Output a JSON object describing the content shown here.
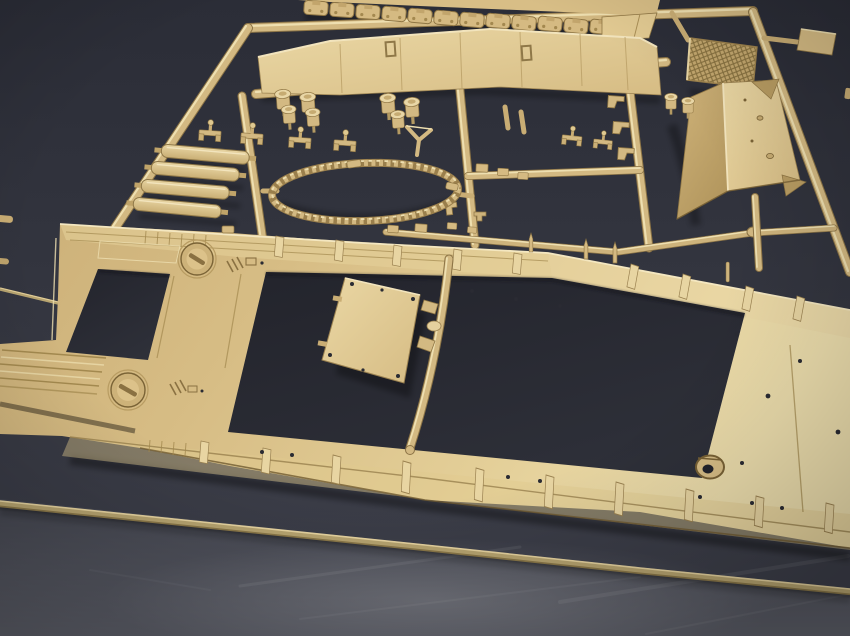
{
  "scene": {
    "type": "photograph",
    "description": "Close-up photo of a sand-tan injection-molded plastic model kit sprue (parts tree) lying on a dark blue-gray studio surface",
    "palette": {
      "backdrop_top": "#2b2d37",
      "backdrop_bottom": "#3e404b",
      "floor_top": "#464852",
      "floor_bottom": "#5d5f69",
      "plastic_base": "#d3b982",
      "plastic_light": "#e9d7a7",
      "plastic_bright": "#f2e4bd",
      "plastic_mid": "#c6ab72",
      "plastic_dark": "#a3894f",
      "plastic_deep": "#6f5a31",
      "rod_olive": "#b7a470",
      "opening_dark": "#23242c"
    },
    "parts": [
      "upper-hull-with-track-links",
      "hull-rear-plate",
      "side-skirt-panel",
      "engine-mesh-grille",
      "angled-box-panel",
      "small-box-part",
      "periscope-cylinder-clusters",
      "tie-down-cleats",
      "stowage-planks",
      "tow-cable-ring",
      "funnel-bracket",
      "pipe-clamps",
      "small-blocks-and-hooks",
      "large-hull-frame-with-hatches",
      "screw-slot-hatches",
      "rectangular-access-panel",
      "towing-eye",
      "bullet-pins",
      "sprue-runner-grid",
      "long-thin-rod"
    ]
  }
}
